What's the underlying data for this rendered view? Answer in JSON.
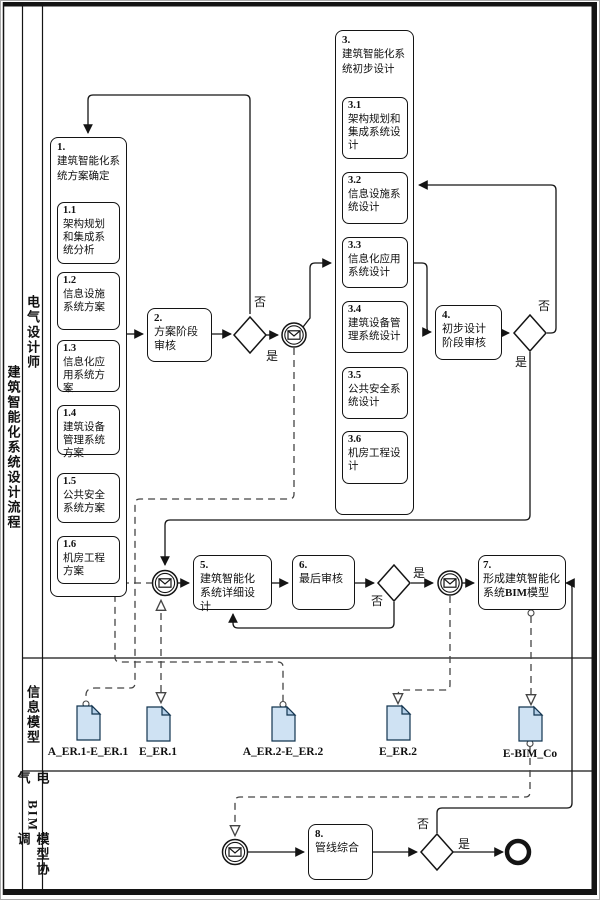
{
  "pool": {
    "title": "建筑智能化系统设计流程"
  },
  "lanes": {
    "lane1": {
      "label": "电气设计师"
    },
    "lane2": {
      "label": "信息模型"
    },
    "lane3": {
      "label_pre": "电气",
      "label_bold": "BIM",
      "label_post": "模型协调"
    }
  },
  "labels": {
    "yes": "是",
    "no": "否"
  },
  "activities": {
    "a1": {
      "num": "1.",
      "label": "建筑智能化系统方案确定"
    },
    "a1_subs": [
      {
        "num": "1.1",
        "label": "架构规划和集成系统分析"
      },
      {
        "num": "1.2",
        "label": "信息设施系统方案"
      },
      {
        "num": "1.3",
        "label": "信息化应用系统方案"
      },
      {
        "num": "1.4",
        "label": "建筑设备管理系统方案"
      },
      {
        "num": "1.5",
        "label": "公共安全系统方案"
      },
      {
        "num": "1.6",
        "label": "机房工程方案"
      }
    ],
    "a2": {
      "num": "2.",
      "label": "方案阶段审核"
    },
    "a3": {
      "num": "3.",
      "label": "建筑智能化系统初步设计"
    },
    "a3_subs": [
      {
        "num": "3.1",
        "label": "架构规划和集成系统设计"
      },
      {
        "num": "3.2",
        "label": "信息设施系统设计"
      },
      {
        "num": "3.3",
        "label": "信息化应用系统设计"
      },
      {
        "num": "3.4",
        "label": "建筑设备管理系统设计"
      },
      {
        "num": "3.5",
        "label": "公共安全系统设计"
      },
      {
        "num": "3.6",
        "label": "机房工程设计"
      }
    ],
    "a4": {
      "num": "4.",
      "label": "初步设计阶段审核"
    },
    "a5": {
      "num": "5.",
      "label": "建筑智能化系统详细设计"
    },
    "a6": {
      "num": "6.",
      "label": "最后审核"
    },
    "a7": {
      "num": "7.",
      "label_pre": "形成建筑智能化系统",
      "label_bold": "BIM",
      "label_post": "模型"
    },
    "a8": {
      "num": "8.",
      "label": "管线综合"
    }
  },
  "documents": [
    {
      "label": "A_ER.1-E_ER.1"
    },
    {
      "label": "E_ER.1"
    },
    {
      "label": "A_ER.2-E_ER.2"
    },
    {
      "label": "E_ER.2"
    },
    {
      "label": "E-BIM_Co"
    }
  ],
  "icons": {
    "message_event": "envelope-icon",
    "gateway": "diamond-gateway-icon",
    "end_event": "thick-circle-end-icon",
    "document": "data-object-icon"
  },
  "colors": {
    "line": "#141414",
    "dashed_line": "#444444",
    "document_fill": "#cfe2f3",
    "document_fold": "#b4cfe8"
  }
}
